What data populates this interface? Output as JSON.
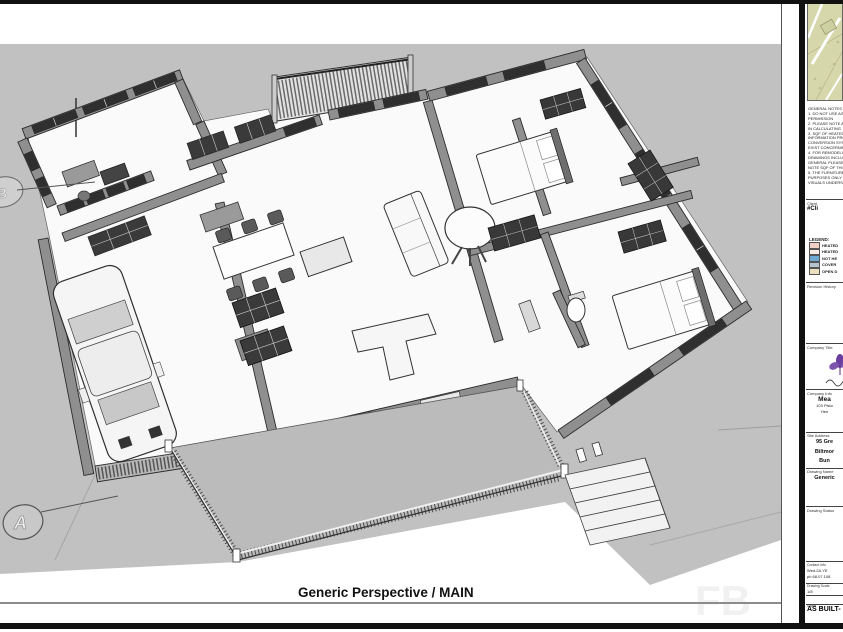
{
  "sheet": {
    "view_title": "Generic Perspective / MAIN",
    "watermark": "FB",
    "background_color": "#c1c1c1",
    "markers": {
      "section_a": "A",
      "section_b": "B"
    }
  },
  "title_block": {
    "general_notes": "GENERAL NOTES\n1. DO NOT USE AS A\nPERMISSION\n2. PLEASE NOTE AL\nIN CALCULATING\n3. SQF OF HEATED\nINFORMATION PRO\nCONVERSION SYS\nEXIST CONCERNIN\n4. FOR REMODELIN\nDRAWINGS INCLU\nGENERAL PLEASE\nNOTE SQF OF THIS\n5. THE FURNITURE\nPURPOSES ONLY\nVISUALS UNDERST",
    "client": {
      "label": "Client",
      "value": "#Cli"
    },
    "legend": {
      "heading": "LEGEND:",
      "items": [
        {
          "label": "HEATED",
          "color": "#f0cfc7"
        },
        {
          "label": "HEATED",
          "color": "#f9ebe4"
        },
        {
          "label": "NOT HE",
          "color": "#6fa8d2"
        },
        {
          "label": "COVER",
          "color": "#b7c3cd"
        },
        {
          "label": "OPEN D",
          "color": "#eadfbe"
        }
      ]
    },
    "revision_history_label": "Revision History",
    "company_title_label": "Company Title",
    "company_info": {
      "label": "Company Info",
      "name": "Mea",
      "address_line1": "103 Pisto",
      "address_line2": "Hen"
    },
    "site_address": {
      "label": "Site Address",
      "lines": [
        "95 Gre",
        "Biltmor",
        "Bun"
      ]
    },
    "drawing_name": {
      "label": "Drawing Name",
      "value": "Generic"
    },
    "drawing_status": {
      "label": "Drawing Status",
      "value": "AS BUILT-"
    },
    "contact": {
      "label": "Contact Info",
      "lines": [
        "Wed.2A.YE",
        "ph 68.07.108"
      ]
    },
    "scale": {
      "label": "Drawing Scale",
      "value": "1/8"
    },
    "sheet_no": {
      "label": "Sheet",
      "value": "1"
    }
  }
}
